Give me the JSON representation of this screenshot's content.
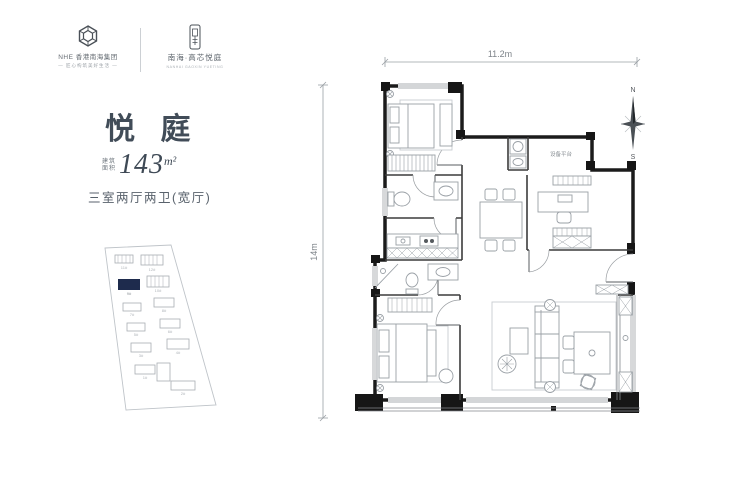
{
  "brand": {
    "left_logo": {
      "icon": "hex-knot-emblem",
      "company": "NHE 香港南海集团",
      "tagline": "— 匠心构筑美好生活 —"
    },
    "right_logo": {
      "icon": "seal-emblem",
      "project": "南海·高芯悦庭",
      "subtitle": "NANHAI GAOXIN YUETING"
    }
  },
  "unit": {
    "title": "悦 庭",
    "area_label_1": "建筑",
    "area_label_2": "面积",
    "area_value": "143",
    "area_unit": "m²",
    "layout": "三室两厅两卫(宽厅)"
  },
  "floor_plan": {
    "dim_width": "11.2m",
    "dim_height": "14m",
    "compass_north": "N",
    "compass_south": "S",
    "room_labels": {
      "equipment_platform": "设备平台"
    }
  },
  "site_plan": {
    "highlight_color": "#1e2b4d",
    "buildings": [
      {
        "label": "11#"
      },
      {
        "label": "12#"
      },
      {
        "label": "9#",
        "highlighted": true
      },
      {
        "label": "10#"
      },
      {
        "label": "7#"
      },
      {
        "label": "8#"
      },
      {
        "label": "5#"
      },
      {
        "label": "6#"
      },
      {
        "label": "3#"
      },
      {
        "label": "4#"
      },
      {
        "label": "1#"
      },
      {
        "label": "2#"
      }
    ]
  }
}
